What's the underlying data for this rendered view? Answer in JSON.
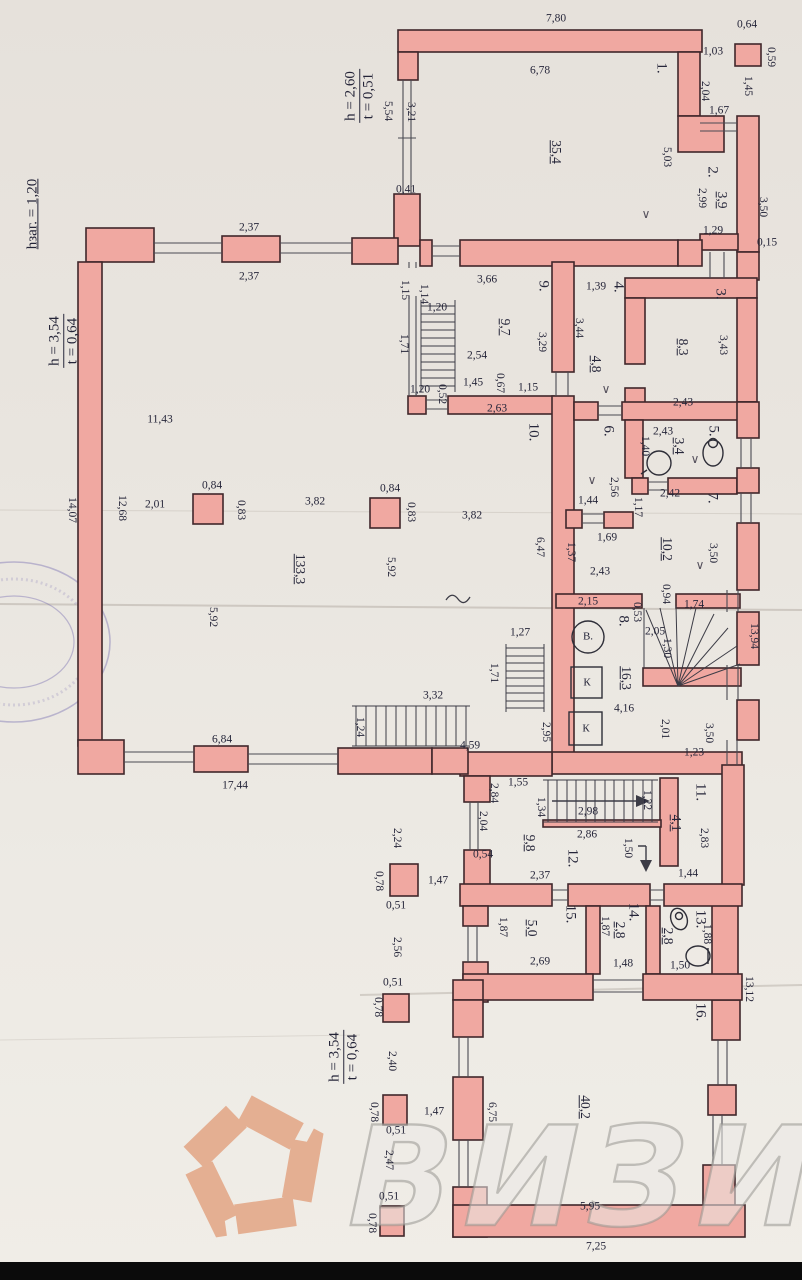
{
  "document": {
    "type": "floor-plan",
    "watermark": {
      "text": "ВИЗИТ"
    },
    "logo": {
      "shape": "pentagon-aperture",
      "color": "#e4af92"
    },
    "colors": {
      "wall": "#f0a8a1",
      "outline": "#40272b",
      "paper": "#eae6e0",
      "ink": "#26263a"
    }
  },
  "rooms": [
    {
      "num": "1.",
      "area": "35,4"
    },
    {
      "num": "2.",
      "area": "3,9"
    },
    {
      "num": "3.",
      "area": "8,3"
    },
    {
      "num": "4.",
      "area": "4,8"
    },
    {
      "num": "5.",
      "area": "3,4"
    },
    {
      "num": "6.",
      "area": "3,7"
    },
    {
      "num": "7.",
      "area": "10,2"
    },
    {
      "num": "8.",
      "area": "16,3"
    },
    {
      "num": "9.",
      "area": "9,7"
    },
    {
      "num": "10.",
      "area": "133,3"
    },
    {
      "num": "11.",
      "area": "4,1"
    },
    {
      "num": "12.",
      "area": "9,8"
    },
    {
      "num": "13.",
      "area": "2,8"
    },
    {
      "num": "14.",
      "area": "2,8"
    },
    {
      "num": "15.",
      "area": "5,0"
    },
    {
      "num": "16.",
      "area": "40,2"
    }
  ],
  "notes": [
    {
      "top": "h = 2,60",
      "bottom": "t = 0,51",
      "x": 360,
      "y": 96
    },
    {
      "top": "hзаг. = 1,20",
      "bottom": "",
      "x": 33,
      "y": 214
    },
    {
      "top": "h = 3,54",
      "bottom": "t = 0,64",
      "x": 64,
      "y": 341
    },
    {
      "top": "h = 3,54",
      "bottom": "t = 0,64",
      "x": 344,
      "y": 1057
    }
  ],
  "labels": [
    [
      "7,80",
      556,
      19,
      0,
      "d"
    ],
    [
      "0,64",
      747,
      25,
      0,
      "d"
    ],
    [
      "0,59",
      770,
      57,
      90,
      "d"
    ],
    [
      "1,03",
      713,
      52,
      0,
      "d"
    ],
    [
      "1,45",
      747,
      86,
      90,
      "d"
    ],
    [
      "2,04",
      704,
      91,
      90,
      "d"
    ],
    [
      "6,78",
      540,
      71,
      0,
      "d"
    ],
    [
      "1.",
      661,
      68,
      90,
      "n"
    ],
    [
      "5,54",
      387,
      111,
      90,
      "d"
    ],
    [
      "3,21",
      410,
      112,
      90,
      "d"
    ],
    [
      "35,4",
      556,
      152,
      90,
      "a"
    ],
    [
      "5,03",
      666,
      157,
      90,
      "d"
    ],
    [
      "1,67",
      719,
      111,
      0,
      "d"
    ],
    [
      "2.",
      712,
      172,
      90,
      "n"
    ],
    [
      "2,99",
      701,
      198,
      90,
      "d"
    ],
    [
      "3,9",
      722,
      200,
      90,
      "a"
    ],
    [
      "3,50",
      762,
      207,
      90,
      "d"
    ],
    [
      "0,41",
      406,
      190,
      0,
      "d"
    ],
    [
      "1,29",
      713,
      231,
      0,
      "d"
    ],
    [
      "0,15",
      767,
      243,
      0,
      "d"
    ],
    [
      "∨",
      646,
      214,
      0,
      "m"
    ],
    [
      "2,37",
      249,
      228,
      0,
      "d"
    ],
    [
      "2,37",
      249,
      277,
      0,
      "d"
    ],
    [
      "3,66",
      487,
      280,
      0,
      "d"
    ],
    [
      "9.",
      543,
      286,
      90,
      "n"
    ],
    [
      "1,15",
      404,
      290,
      90,
      "d"
    ],
    [
      "1,14",
      423,
      294,
      90,
      "d"
    ],
    [
      "1,20",
      437,
      308,
      0,
      "d"
    ],
    [
      "1,39",
      596,
      287,
      0,
      "d"
    ],
    [
      "4.",
      618,
      287,
      90,
      "n"
    ],
    [
      "3.",
      720,
      294,
      90,
      "n"
    ],
    [
      "1,71",
      403,
      344,
      90,
      "d"
    ],
    [
      "9,7",
      505,
      327,
      90,
      "a"
    ],
    [
      "3,29",
      541,
      342,
      90,
      "d"
    ],
    [
      "2,54",
      477,
      356,
      0,
      "d"
    ],
    [
      "3,44",
      578,
      328,
      90,
      "d"
    ],
    [
      "4,8",
      596,
      364,
      90,
      "a"
    ],
    [
      "8,3",
      683,
      347,
      90,
      "a"
    ],
    [
      "3,43",
      722,
      345,
      90,
      "d"
    ],
    [
      "1,45",
      473,
      383,
      0,
      "d"
    ],
    [
      "0,67",
      499,
      383,
      90,
      "d"
    ],
    [
      "1,15",
      528,
      388,
      0,
      "d"
    ],
    [
      "1,20",
      420,
      390,
      0,
      "d"
    ],
    [
      "0,52",
      441,
      394,
      90,
      "d"
    ],
    [
      "2,63",
      497,
      409,
      0,
      "d"
    ],
    [
      "2,43",
      683,
      403,
      0,
      "d"
    ],
    [
      "∨",
      606,
      389,
      0,
      "m"
    ],
    [
      "10.",
      533,
      432,
      90,
      "n"
    ],
    [
      "6.",
      608,
      431,
      90,
      "n"
    ],
    [
      "2,43",
      663,
      432,
      0,
      "d"
    ],
    [
      "3,4",
      679,
      446,
      90,
      "a"
    ],
    [
      "5.",
      713,
      431,
      90,
      "n"
    ],
    [
      "1,40",
      644,
      446,
      90,
      "d"
    ],
    [
      "∨",
      695,
      459,
      0,
      "m"
    ],
    [
      "11,43",
      160,
      420,
      0,
      "d"
    ],
    [
      "2,56",
      613,
      487,
      90,
      "d"
    ],
    [
      "∨",
      592,
      480,
      0,
      "m"
    ],
    [
      "1,44",
      588,
      501,
      0,
      "d"
    ],
    [
      "2,42",
      670,
      494,
      0,
      "d"
    ],
    [
      "7.",
      712,
      498,
      90,
      "n"
    ],
    [
      "1,17",
      637,
      507,
      90,
      "d"
    ],
    [
      "1,69",
      607,
      538,
      0,
      "d"
    ],
    [
      "1,37",
      570,
      552,
      90,
      "d"
    ],
    [
      "10,2",
      667,
      549,
      90,
      "a"
    ],
    [
      "3,50",
      712,
      553,
      90,
      "d"
    ],
    [
      "∨",
      700,
      565,
      0,
      "m"
    ],
    [
      "2,43",
      600,
      572,
      0,
      "d"
    ],
    [
      "14,07",
      71,
      510,
      90,
      "d"
    ],
    [
      "12,68",
      121,
      508,
      90,
      "d"
    ],
    [
      "2,01",
      155,
      505,
      0,
      "d"
    ],
    [
      "0,84",
      212,
      486,
      0,
      "d"
    ],
    [
      "0,83",
      240,
      510,
      90,
      "d"
    ],
    [
      "3,82",
      315,
      502,
      0,
      "d"
    ],
    [
      "0,84",
      390,
      489,
      0,
      "d"
    ],
    [
      "0,83",
      410,
      512,
      90,
      "d"
    ],
    [
      "3,82",
      472,
      516,
      0,
      "d"
    ],
    [
      "133,3",
      300,
      569,
      90,
      "a"
    ],
    [
      "5,92",
      390,
      567,
      90,
      "d"
    ],
    [
      "5,92",
      212,
      617,
      90,
      "d"
    ],
    [
      "6,47",
      539,
      547,
      90,
      "d"
    ],
    [
      "2,15",
      588,
      602,
      0,
      "d"
    ],
    [
      "0,94",
      665,
      594,
      90,
      "d"
    ],
    [
      "1,74",
      694,
      605,
      0,
      "d"
    ],
    [
      "0,53",
      636,
      612,
      90,
      "d"
    ],
    [
      "8.",
      623,
      621,
      90,
      "n"
    ],
    [
      "13,94",
      753,
      636,
      90,
      "d"
    ],
    [
      "2,05",
      655,
      632,
      0,
      "d"
    ],
    [
      "1,30",
      666,
      648,
      90,
      "d"
    ],
    [
      "16,3",
      626,
      678,
      90,
      "a"
    ],
    [
      "4,16",
      624,
      709,
      0,
      "d"
    ],
    [
      "2,01",
      664,
      729,
      90,
      "d"
    ],
    [
      "3,50",
      708,
      733,
      90,
      "d"
    ],
    [
      "1,23",
      694,
      753,
      0,
      "d"
    ],
    [
      "В.",
      588,
      637,
      0,
      "fx"
    ],
    [
      "К",
      587,
      683,
      0,
      "fx"
    ],
    [
      "К",
      586,
      729,
      0,
      "fx"
    ],
    [
      "1,27",
      520,
      633,
      0,
      "d"
    ],
    [
      "1,71",
      493,
      673,
      90,
      "d"
    ],
    [
      "3,32",
      433,
      696,
      0,
      "d"
    ],
    [
      "1,24",
      359,
      727,
      90,
      "d"
    ],
    [
      "2,95",
      545,
      732,
      90,
      "d"
    ],
    [
      "6,84",
      222,
      740,
      0,
      "d"
    ],
    [
      "4,59",
      470,
      746,
      0,
      "d"
    ],
    [
      "17,44",
      235,
      786,
      0,
      "d"
    ],
    [
      "1,55",
      518,
      783,
      0,
      "d"
    ],
    [
      "2,84",
      493,
      793,
      90,
      "d"
    ],
    [
      "11.",
      700,
      792,
      90,
      "n"
    ],
    [
      "1,34",
      540,
      807,
      90,
      "d"
    ],
    [
      "2,98",
      588,
      812,
      0,
      "d"
    ],
    [
      "1,22",
      646,
      800,
      90,
      "d"
    ],
    [
      "2,04",
      482,
      821,
      90,
      "d"
    ],
    [
      "4,1",
      676,
      823,
      90,
      "a"
    ],
    [
      "2,83",
      703,
      838,
      90,
      "d"
    ],
    [
      "2,86",
      587,
      835,
      0,
      "d"
    ],
    [
      "9,8",
      530,
      843,
      90,
      "a"
    ],
    [
      "12.",
      572,
      858,
      90,
      "n"
    ],
    [
      "1,50",
      627,
      848,
      90,
      "d"
    ],
    [
      "0,54",
      483,
      855,
      0,
      "d"
    ],
    [
      "2,24",
      396,
      838,
      90,
      "d"
    ],
    [
      "1,47",
      438,
      881,
      0,
      "d"
    ],
    [
      "0,78",
      378,
      881,
      90,
      "d"
    ],
    [
      "2,37",
      540,
      876,
      0,
      "d"
    ],
    [
      "1,44",
      688,
      874,
      0,
      "d"
    ],
    [
      "0,51",
      396,
      906,
      0,
      "d"
    ],
    [
      "15.",
      570,
      914,
      90,
      "n"
    ],
    [
      "1,87",
      502,
      927,
      90,
      "d"
    ],
    [
      "5,0",
      532,
      928,
      90,
      "a"
    ],
    [
      "14.",
      633,
      912,
      90,
      "n"
    ],
    [
      "1,87",
      604,
      926,
      90,
      "d"
    ],
    [
      "2,8",
      620,
      930,
      90,
      "a"
    ],
    [
      "13.",
      700,
      919,
      90,
      "n"
    ],
    [
      "1,88",
      706,
      934,
      90,
      "d"
    ],
    [
      "2,8",
      668,
      936,
      90,
      "a"
    ],
    [
      "2,69",
      540,
      962,
      0,
      "d"
    ],
    [
      "1,48",
      623,
      964,
      0,
      "d"
    ],
    [
      "1,50",
      680,
      966,
      0,
      "d"
    ],
    [
      "2,56",
      396,
      947,
      90,
      "d"
    ],
    [
      "0,51",
      393,
      983,
      0,
      "d"
    ],
    [
      "0,78",
      377,
      1007,
      90,
      "d"
    ],
    [
      "16.",
      700,
      1012,
      90,
      "n"
    ],
    [
      "13,12",
      748,
      989,
      90,
      "d"
    ],
    [
      "40,2",
      585,
      1107,
      90,
      "a"
    ],
    [
      "6,75",
      491,
      1112,
      90,
      "d"
    ],
    [
      "1,47",
      434,
      1112,
      0,
      "d"
    ],
    [
      "0,78",
      373,
      1112,
      90,
      "d"
    ],
    [
      "0,51",
      396,
      1131,
      0,
      "d"
    ],
    [
      "2,40",
      391,
      1061,
      90,
      "d"
    ],
    [
      "2,47",
      388,
      1160,
      90,
      "d"
    ],
    [
      "0,51",
      389,
      1197,
      0,
      "d"
    ],
    [
      "0,78",
      371,
      1223,
      90,
      "d"
    ],
    [
      "5,95",
      590,
      1207,
      0,
      "d"
    ],
    [
      "7,25",
      596,
      1247,
      0,
      "d"
    ]
  ]
}
